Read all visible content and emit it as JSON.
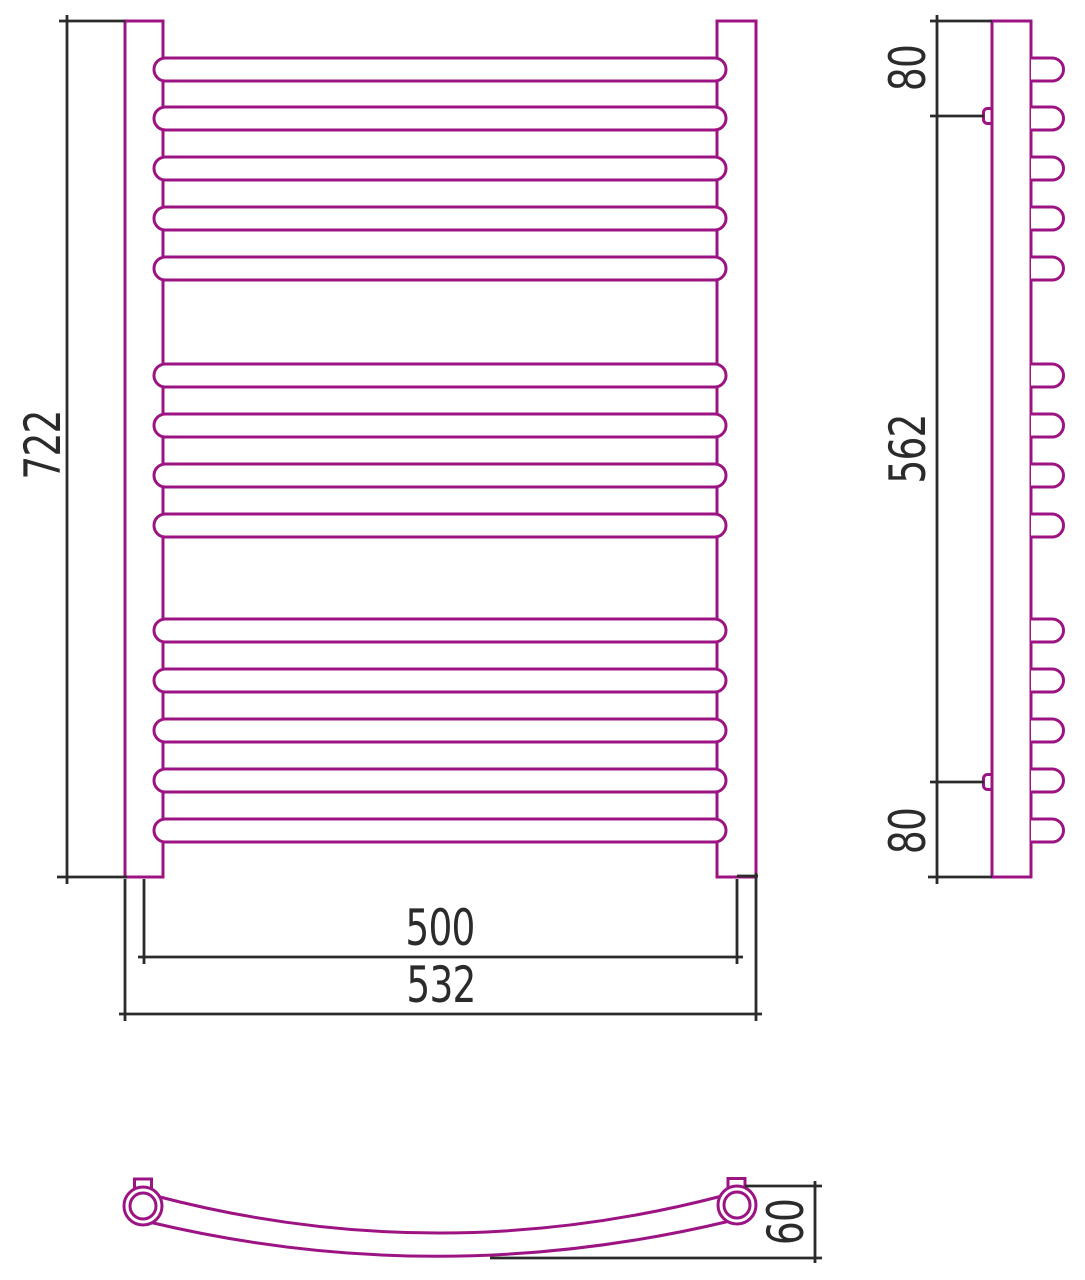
{
  "drawing": {
    "dimensions": {
      "front": {
        "height": "722",
        "axis_width": "500",
        "overall_width": "532"
      },
      "side": {
        "top_bracket_offset": "80",
        "bracket_span": "562",
        "bottom_bracket_offset": "80"
      },
      "bottom": {
        "depth": "60"
      }
    }
  },
  "colors": {
    "product": "#9C1483",
    "dimension": "#2B2B2B",
    "background": "#FFFFFF"
  }
}
